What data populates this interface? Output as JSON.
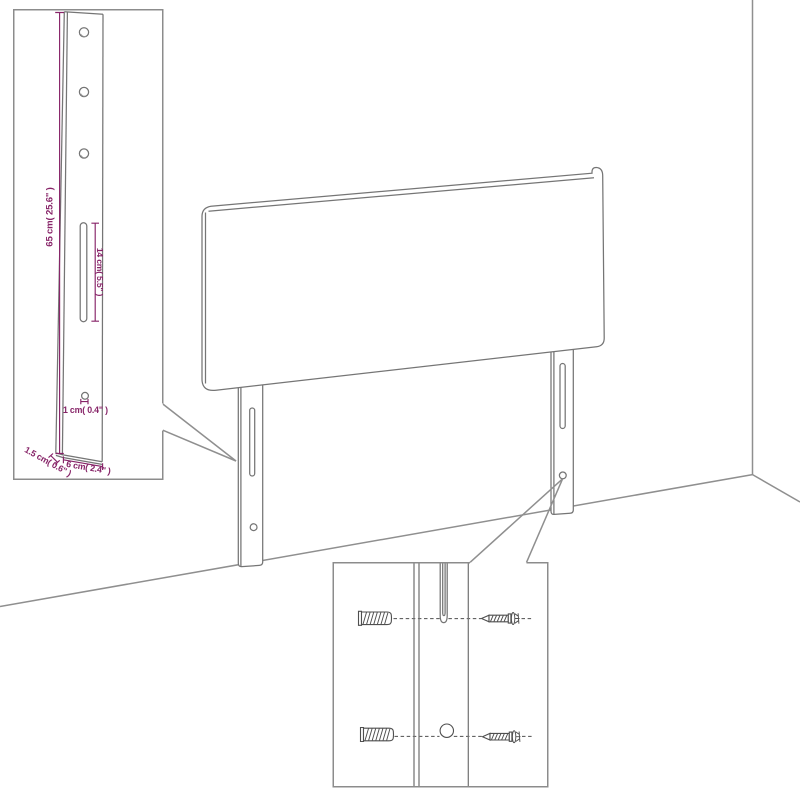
{
  "figure": {
    "subject": "headboard-wall-mount-assembly-diagram",
    "background_color": "#ffffff",
    "drawing_line_color": "#7a7a7a",
    "room_line_color": "#8f8f8f",
    "dimension_accent_color": "#872468",
    "leg_detail_inset": {
      "labels": {
        "leg_height": "65 cm( 25.6\" )",
        "slot_length": "14 cm( 5.5\" )",
        "hole_diameter": "1 cm( 0.4\" )",
        "leg_thickness": "1.5 cm( 0.6\" )",
        "leg_width": "6 cm( 2.4\" )"
      }
    },
    "mounting_detail_inset": {
      "icons": [
        "wall-plug-icon",
        "screw-icon"
      ],
      "wall_plug_count": 2,
      "screw_count": 2
    }
  }
}
